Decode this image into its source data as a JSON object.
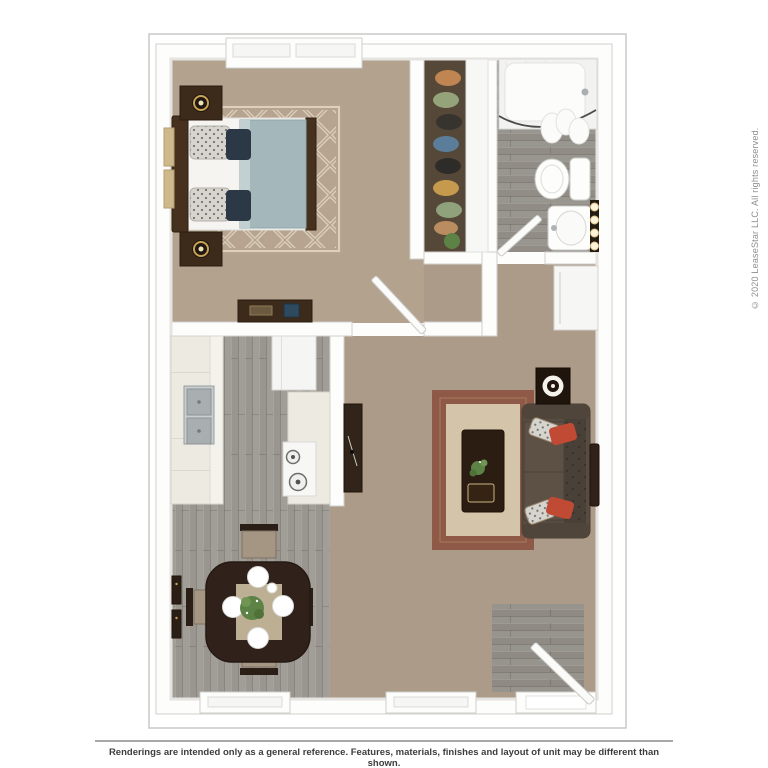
{
  "image_title": "3D top-down apartment floor plan rendering",
  "copyright_notice": "© 2020 LeaseStar LLC. All rights reserved.",
  "disclaimer": "Renderings are intended only as a general reference. Features, materials, finishes and layout of unit may be different than shown.",
  "palette": {
    "page_bg": "#ffffff",
    "plan_border": "#c9c9c7",
    "wall": "#fdfdfc",
    "wall_stroke": "#d2d0cd",
    "carpet_bedroom": "#b2a28e",
    "carpet_living": "#ab9b88",
    "wood_gray": "#9a968f",
    "wood_bath": "#918d86",
    "wood_entry": "#8f8b84",
    "closet_floor": "#564838",
    "furniture_dark": "#3c2a1b",
    "comforter_blue": "#a4b8bb",
    "rug_trellis_base": "#b6a490",
    "rug_trellis_line": "#ddd1bc",
    "living_rug_border": "#8e5a47",
    "living_rug_center": "#d3c4aa",
    "sofa_body": "#574c42",
    "sofa_back": "#494037",
    "pillow_red": "#c04a33",
    "pillow_tan": "#b29a79",
    "pillow_navy": "#2c3845",
    "plant_green": "#5d8246",
    "steel": "#b3b8ba",
    "lamp_gold": "#c8a254",
    "copyright_color": "#8f8f8f",
    "disclaimer_color": "#3d3d3d",
    "divider_color": "#a8a8a8"
  },
  "floorplan": {
    "view": "top-down 3D rendering, no text labels on rooms",
    "rooms": [
      {
        "name": "bedroom",
        "flooring": "tan carpet",
        "contents": [
          "bed with blue comforter",
          "damask and navy pillows",
          "two nightstands with lamps",
          "trellis rug",
          "dresser",
          "wall art",
          "window"
        ]
      },
      {
        "name": "closet",
        "flooring": "dark wood",
        "contents": [
          "hanging clothes",
          "plant"
        ]
      },
      {
        "name": "bathroom",
        "flooring": "gray plank",
        "contents": [
          "bathtub with shower curtain",
          "toilet",
          "pedestal sink",
          "vanity lights",
          "door"
        ]
      },
      {
        "name": "kitchen",
        "flooring": "gray plank",
        "contents": [
          "white cabinets",
          "double sink",
          "refrigerator",
          "range with burners"
        ]
      },
      {
        "name": "dining-area",
        "flooring": "gray plank",
        "contents": [
          "dark wood table",
          "four chairs",
          "four plates",
          "centerpiece plant",
          "two wall frames",
          "window"
        ]
      },
      {
        "name": "living-room",
        "flooring": "tan carpet",
        "contents": [
          "sofa with red pillows",
          "coffee table with plant and tray",
          "bordered area rug",
          "speaker side table",
          "wall tv",
          "media console",
          "storage cabinet",
          "window"
        ]
      },
      {
        "name": "entry",
        "flooring": "gray plank",
        "contents": [
          "front door"
        ]
      }
    ]
  }
}
